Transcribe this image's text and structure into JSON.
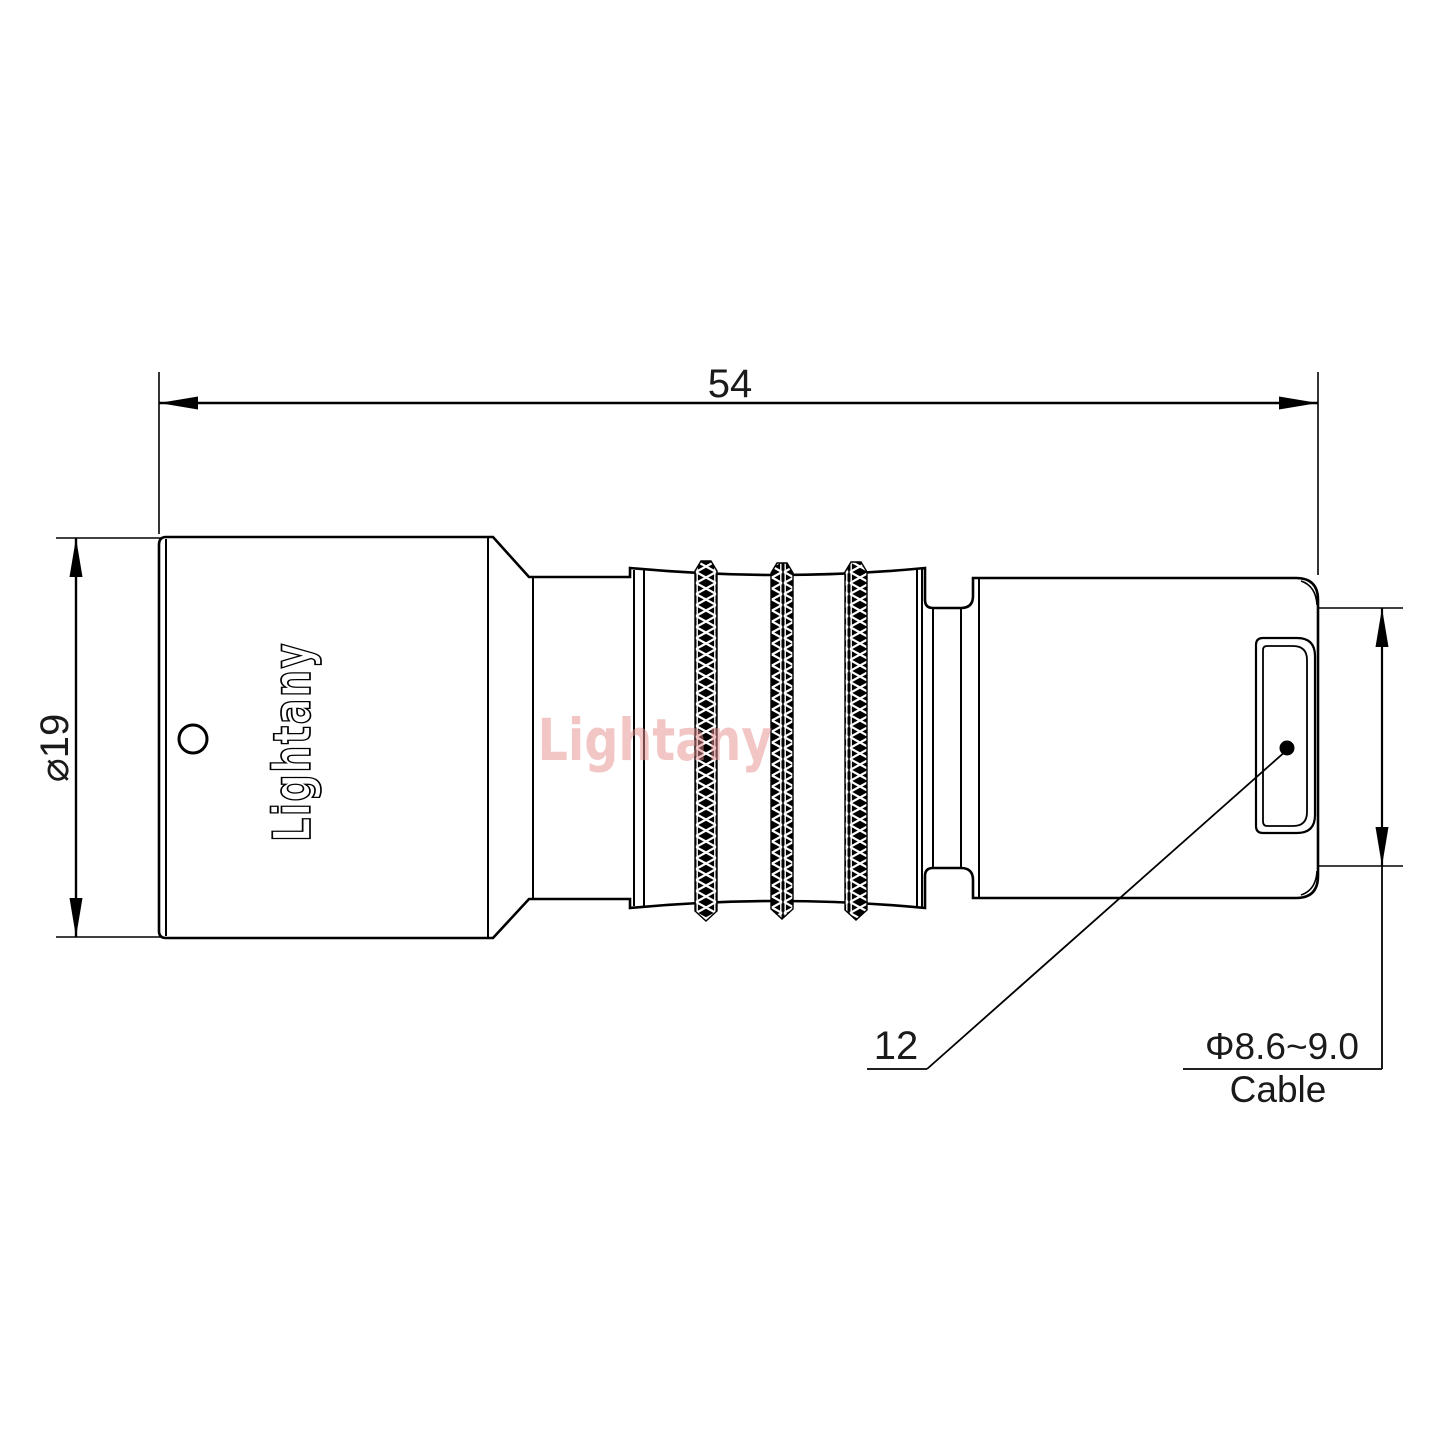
{
  "title": "Connector technical drawing",
  "canvas": {
    "background": "#ffffff",
    "line_color": "#000000",
    "text_color": "#1a1a1a"
  },
  "watermark": {
    "text": "Lightany",
    "color": "#e88f8f"
  },
  "connector": {
    "logo_engraving": "Lightany"
  },
  "dimensions": {
    "overall_length": {
      "value": "54"
    },
    "body_diameter": {
      "value": "⌀19"
    },
    "rear_diameter": {
      "value": "12"
    },
    "cable": {
      "spec": "Φ8.6~9.0",
      "label": "Cable"
    }
  }
}
